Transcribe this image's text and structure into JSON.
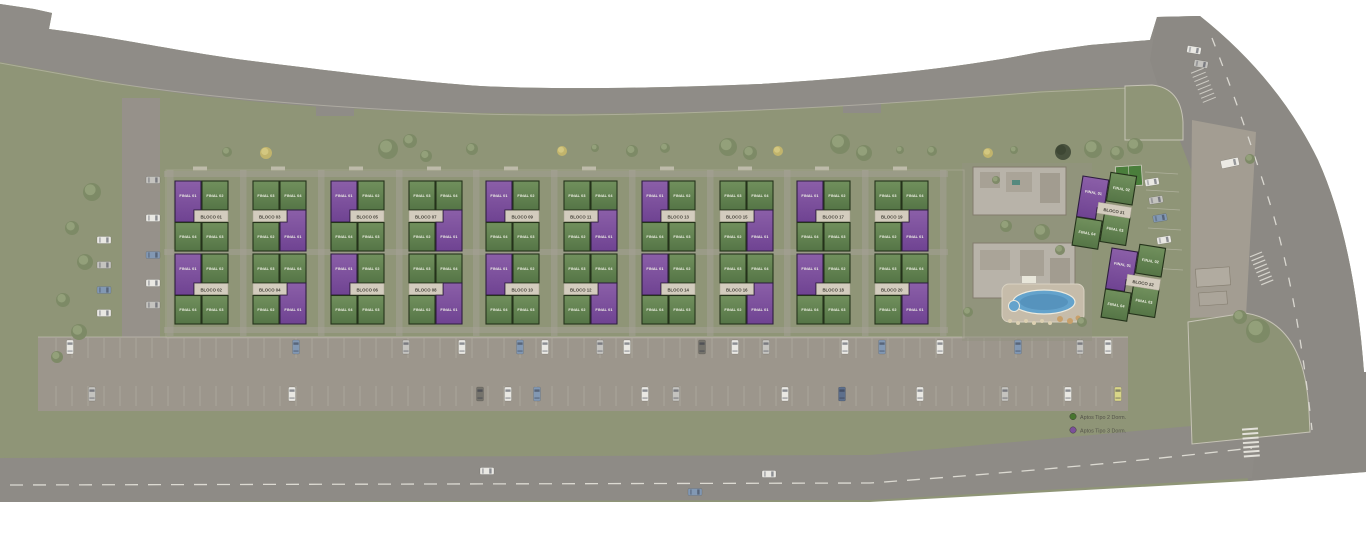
{
  "scene": {
    "type": "residential-masterplan-site-plan",
    "description": "Aerial rendered site plan with 22 apartment blocks, internal roads, parking, pool and leisure area"
  },
  "legend": {
    "items": [
      {
        "id": "tipo2",
        "label": "Aptos Tipo 2 Dorm.",
        "color": "#47752f"
      },
      {
        "id": "tipo3",
        "label": "Aptos Tipo 3 Dorm.",
        "color": "#7b4f9a"
      }
    ]
  },
  "colors": {
    "unit_tipo2_fill": "#5d7d4d",
    "unit_tipo3_fill": "#7e519c",
    "block_label_band": "#d3ccbe",
    "grass": "#8f9577",
    "road": "#8f8c87",
    "parking": "#9c968c",
    "pool_water": "#64a3cc"
  },
  "site": {
    "unit_sets": {
      "A": [
        {
          "label": "FINAL 01",
          "type": "tipo3",
          "pos": "tl"
        },
        {
          "label": "FINAL 02",
          "type": "tipo2",
          "pos": "tr"
        },
        {
          "label": "FINAL 04",
          "type": "tipo2",
          "pos": "bl"
        },
        {
          "label": "FINAL 03",
          "type": "tipo2",
          "pos": "br"
        }
      ],
      "B": [
        {
          "label": "FINAL 03",
          "type": "tipo2",
          "pos": "tl"
        },
        {
          "label": "FINAL 04",
          "type": "tipo2",
          "pos": "tr"
        },
        {
          "label": "FINAL 02",
          "type": "tipo2",
          "pos": "bl"
        },
        {
          "label": "FINAL 01",
          "type": "tipo3",
          "pos": "br"
        }
      ]
    },
    "blocks": [
      {
        "label": "BLOCO 01",
        "variant": "A"
      },
      {
        "label": "BLOCO 02",
        "variant": "A"
      },
      {
        "label": "BLOCO 03",
        "variant": "B"
      },
      {
        "label": "BLOCO 04",
        "variant": "B"
      },
      {
        "label": "BLOCO 05",
        "variant": "A"
      },
      {
        "label": "BLOCO 06",
        "variant": "A"
      },
      {
        "label": "BLOCO 07",
        "variant": "B"
      },
      {
        "label": "BLOCO 08",
        "variant": "B"
      },
      {
        "label": "BLOCO 09",
        "variant": "A"
      },
      {
        "label": "BLOCO 10",
        "variant": "A"
      },
      {
        "label": "BLOCO 11",
        "variant": "B"
      },
      {
        "label": "BLOCO 12",
        "variant": "B"
      },
      {
        "label": "BLOCO 13",
        "variant": "A"
      },
      {
        "label": "BLOCO 14",
        "variant": "A"
      },
      {
        "label": "BLOCO 15",
        "variant": "B"
      },
      {
        "label": "BLOCO 16",
        "variant": "B"
      },
      {
        "label": "BLOCO 17",
        "variant": "A"
      },
      {
        "label": "BLOCO 18",
        "variant": "A"
      },
      {
        "label": "BLOCO 19",
        "variant": "B"
      },
      {
        "label": "BLOCO 20",
        "variant": "B"
      },
      {
        "label": "BLOCO 21",
        "variant": "A",
        "rotated": true
      },
      {
        "label": "BLOCO 22",
        "variant": "A",
        "rotated": true
      }
    ]
  }
}
